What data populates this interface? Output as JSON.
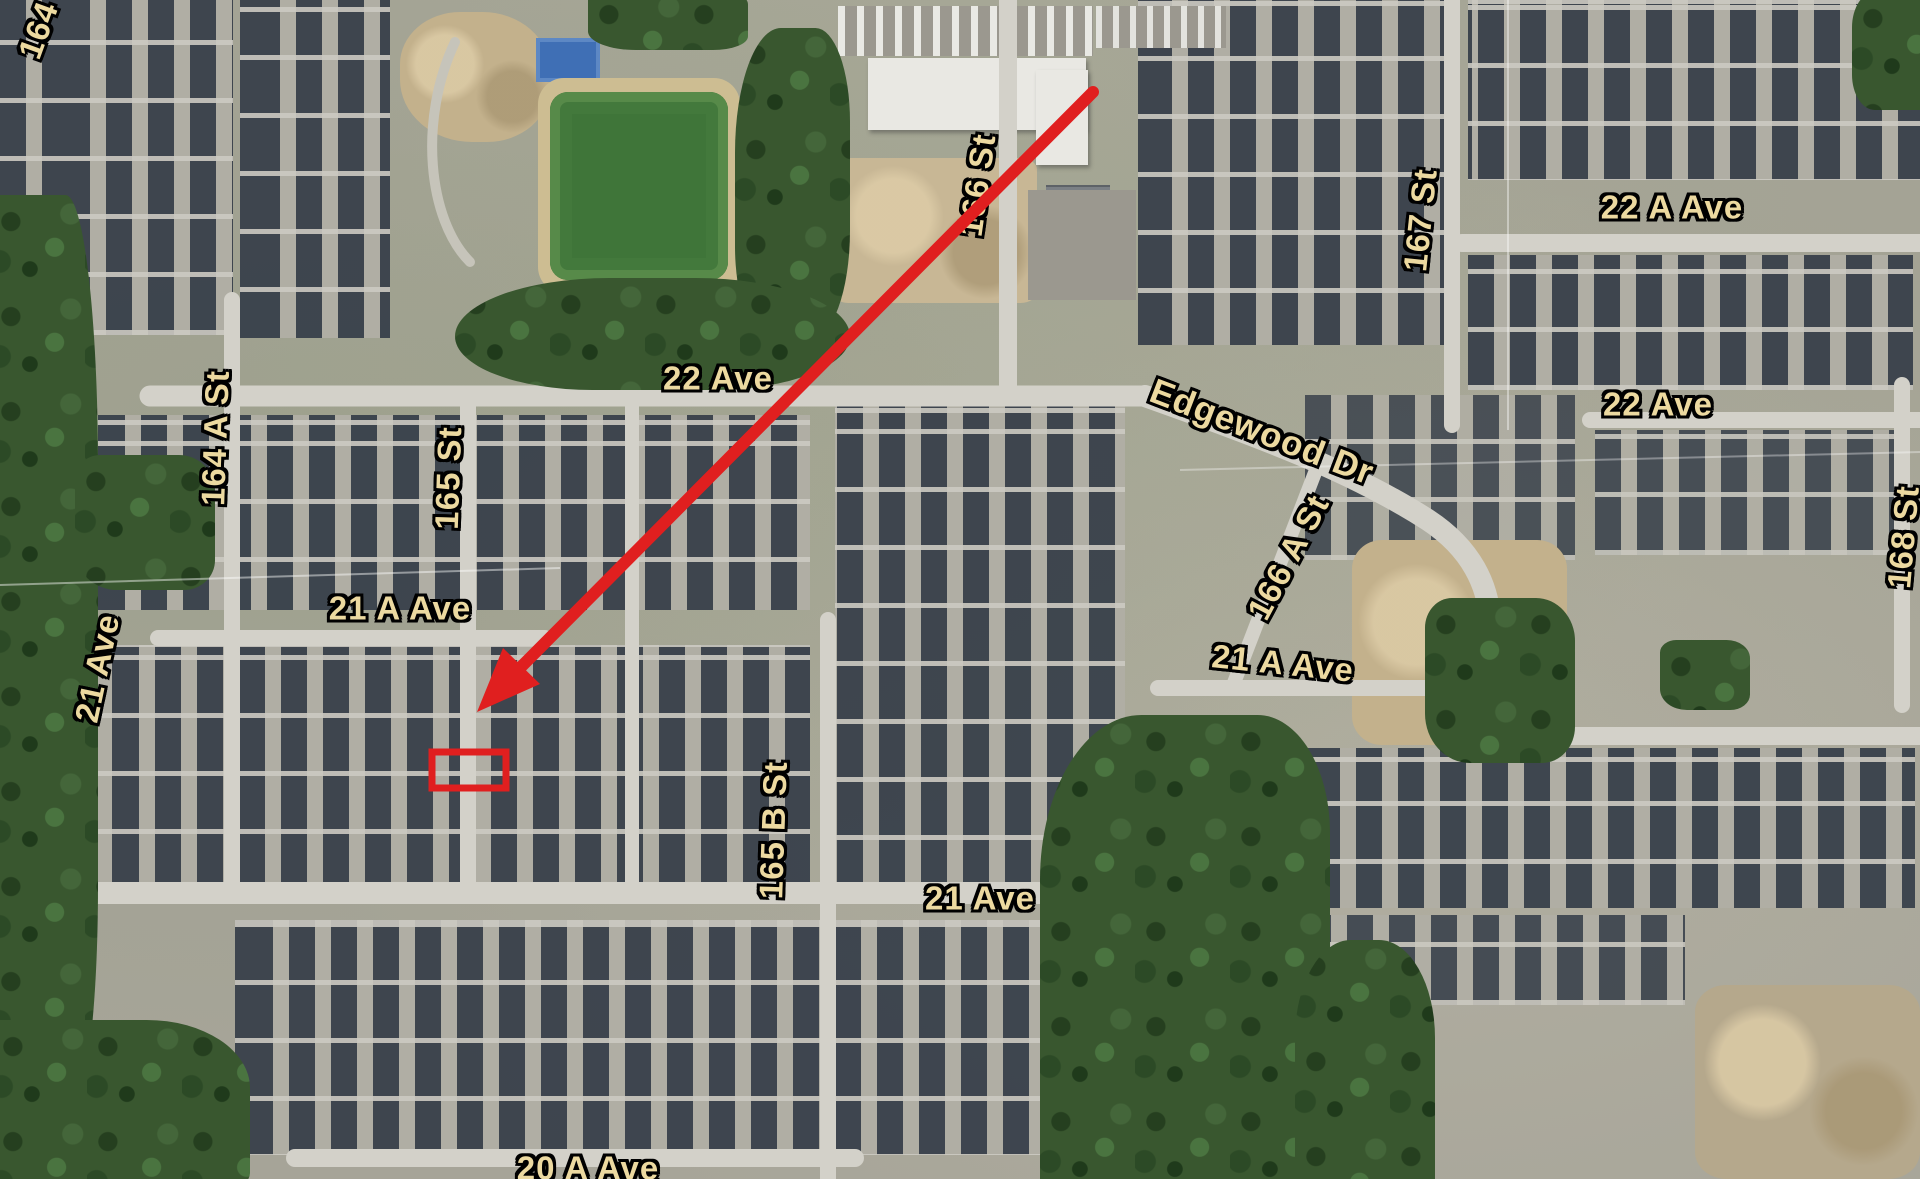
{
  "map": {
    "view": "satellite-aerial-neighborhood",
    "street_labels": [
      {
        "text": "164",
        "x": 38,
        "y": 30,
        "rot": -70
      },
      {
        "text": "164 A St",
        "x": 215,
        "y": 438,
        "rot": -88
      },
      {
        "text": "165 St",
        "x": 448,
        "y": 478,
        "rot": -88
      },
      {
        "text": "22 Ave",
        "x": 718,
        "y": 378,
        "rot": 0
      },
      {
        "text": "166 St",
        "x": 977,
        "y": 185,
        "rot": -82
      },
      {
        "text": "Edgewood Dr",
        "x": 1262,
        "y": 432,
        "rot": 21
      },
      {
        "text": "167 St",
        "x": 1420,
        "y": 220,
        "rot": -84
      },
      {
        "text": "22 A Ave",
        "x": 1672,
        "y": 207,
        "rot": 0
      },
      {
        "text": "22 Ave",
        "x": 1658,
        "y": 404,
        "rot": 0
      },
      {
        "text": "168 St",
        "x": 1903,
        "y": 537,
        "rot": -85
      },
      {
        "text": "166 A St",
        "x": 1288,
        "y": 557,
        "rot": -62
      },
      {
        "text": "21 A Ave",
        "x": 1283,
        "y": 663,
        "rot": 6
      },
      {
        "text": "21 A Ave",
        "x": 400,
        "y": 608,
        "rot": 0
      },
      {
        "text": "21 Ave",
        "x": 97,
        "y": 668,
        "rot": -78
      },
      {
        "text": "165 B St",
        "x": 773,
        "y": 830,
        "rot": -88
      },
      {
        "text": "21 Ave",
        "x": 980,
        "y": 898,
        "rot": 0
      },
      {
        "text": "20 A Ave",
        "x": 588,
        "y": 1168,
        "rot": 0
      }
    ],
    "annotation": {
      "arrow": {
        "x1": 1093,
        "y1": 92,
        "x2": 519,
        "y2": 669,
        "tip_x": 477,
        "tip_y": 712
      },
      "highlight_box": {
        "x": 432,
        "y": 752,
        "w": 74,
        "h": 36
      },
      "color": "#e01f1f"
    },
    "colors": {
      "label_fill": "#ecd9a0",
      "label_outline": "#000000",
      "road": "#d3d1c9",
      "roof": "#3a424c",
      "tree": "#39572f",
      "field": "#3f7539",
      "sand": "#d8c49a",
      "court_blue": "#3f6fb5",
      "annotation_red": "#e01f1f"
    }
  }
}
